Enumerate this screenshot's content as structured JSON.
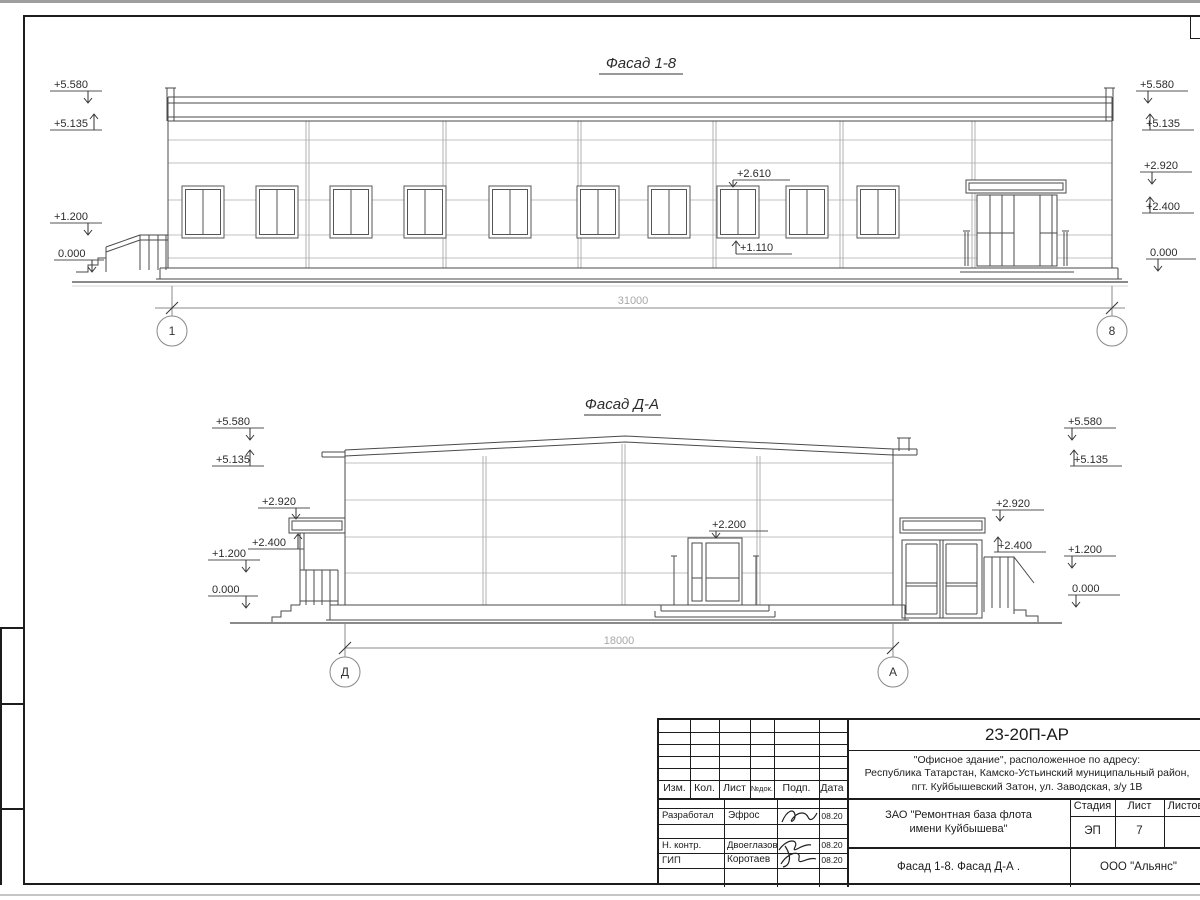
{
  "facade_top": {
    "title": "Фасад 1-8",
    "marks_left": [
      "+5.580",
      "+5.135",
      "+1.200",
      "0.000"
    ],
    "marks_right": [
      "+5.580",
      "+5.135",
      "+2.920",
      "+2.400",
      "0.000"
    ],
    "window_mark_top": "+2.610",
    "window_mark_bottom": "+1.110",
    "dimension": "31000",
    "axis_left": "1",
    "axis_right": "8"
  },
  "facade_bottom": {
    "title": "Фасад Д-А",
    "marks_left": [
      "+5.580",
      "+5.135",
      "+2.920",
      "+2.400",
      "+1.200",
      "0.000"
    ],
    "marks_right": [
      "+5.580",
      "+5.135",
      "+2.920",
      "+2.400",
      "+1.200",
      "0.000"
    ],
    "door_mark": "+2.200",
    "dimension": "18000",
    "axis_left": "Д",
    "axis_right": "А"
  },
  "title_block": {
    "doc_number": "23-20П-АР",
    "project_line1": "\"Офисное здание\", расположенное по адресу:",
    "project_line2": "Республика Татарстан, Камско-Устьинский муниципальный район,",
    "project_line3": "пгт. Куйбышевский Затон, ул. Заводская, з/у 1В",
    "client_line1": "ЗАО \"Ремонтная база флота",
    "client_line2": "имени Куйбышева\"",
    "sheet_title": "Фасад 1-8. Фасад Д-А .",
    "company": "ООО \"Альянс\"",
    "stage_label": "Стадия",
    "sheet_label": "Лист",
    "sheets_label": "Листов",
    "stage_value": "ЭП",
    "sheet_value": "7",
    "header_cols": [
      "Изм.",
      "Кол.",
      "Лист",
      "№док.",
      "Подп.",
      "Дата"
    ],
    "rows": [
      {
        "role": "Разработал",
        "name": "Эфрос",
        "date": "08.20"
      },
      {
        "role": "Н. контр.",
        "name": "Двоеглазов",
        "date": "08.20"
      },
      {
        "role": "ГИП",
        "name": "Коротаев",
        "date": "08.20"
      }
    ]
  }
}
